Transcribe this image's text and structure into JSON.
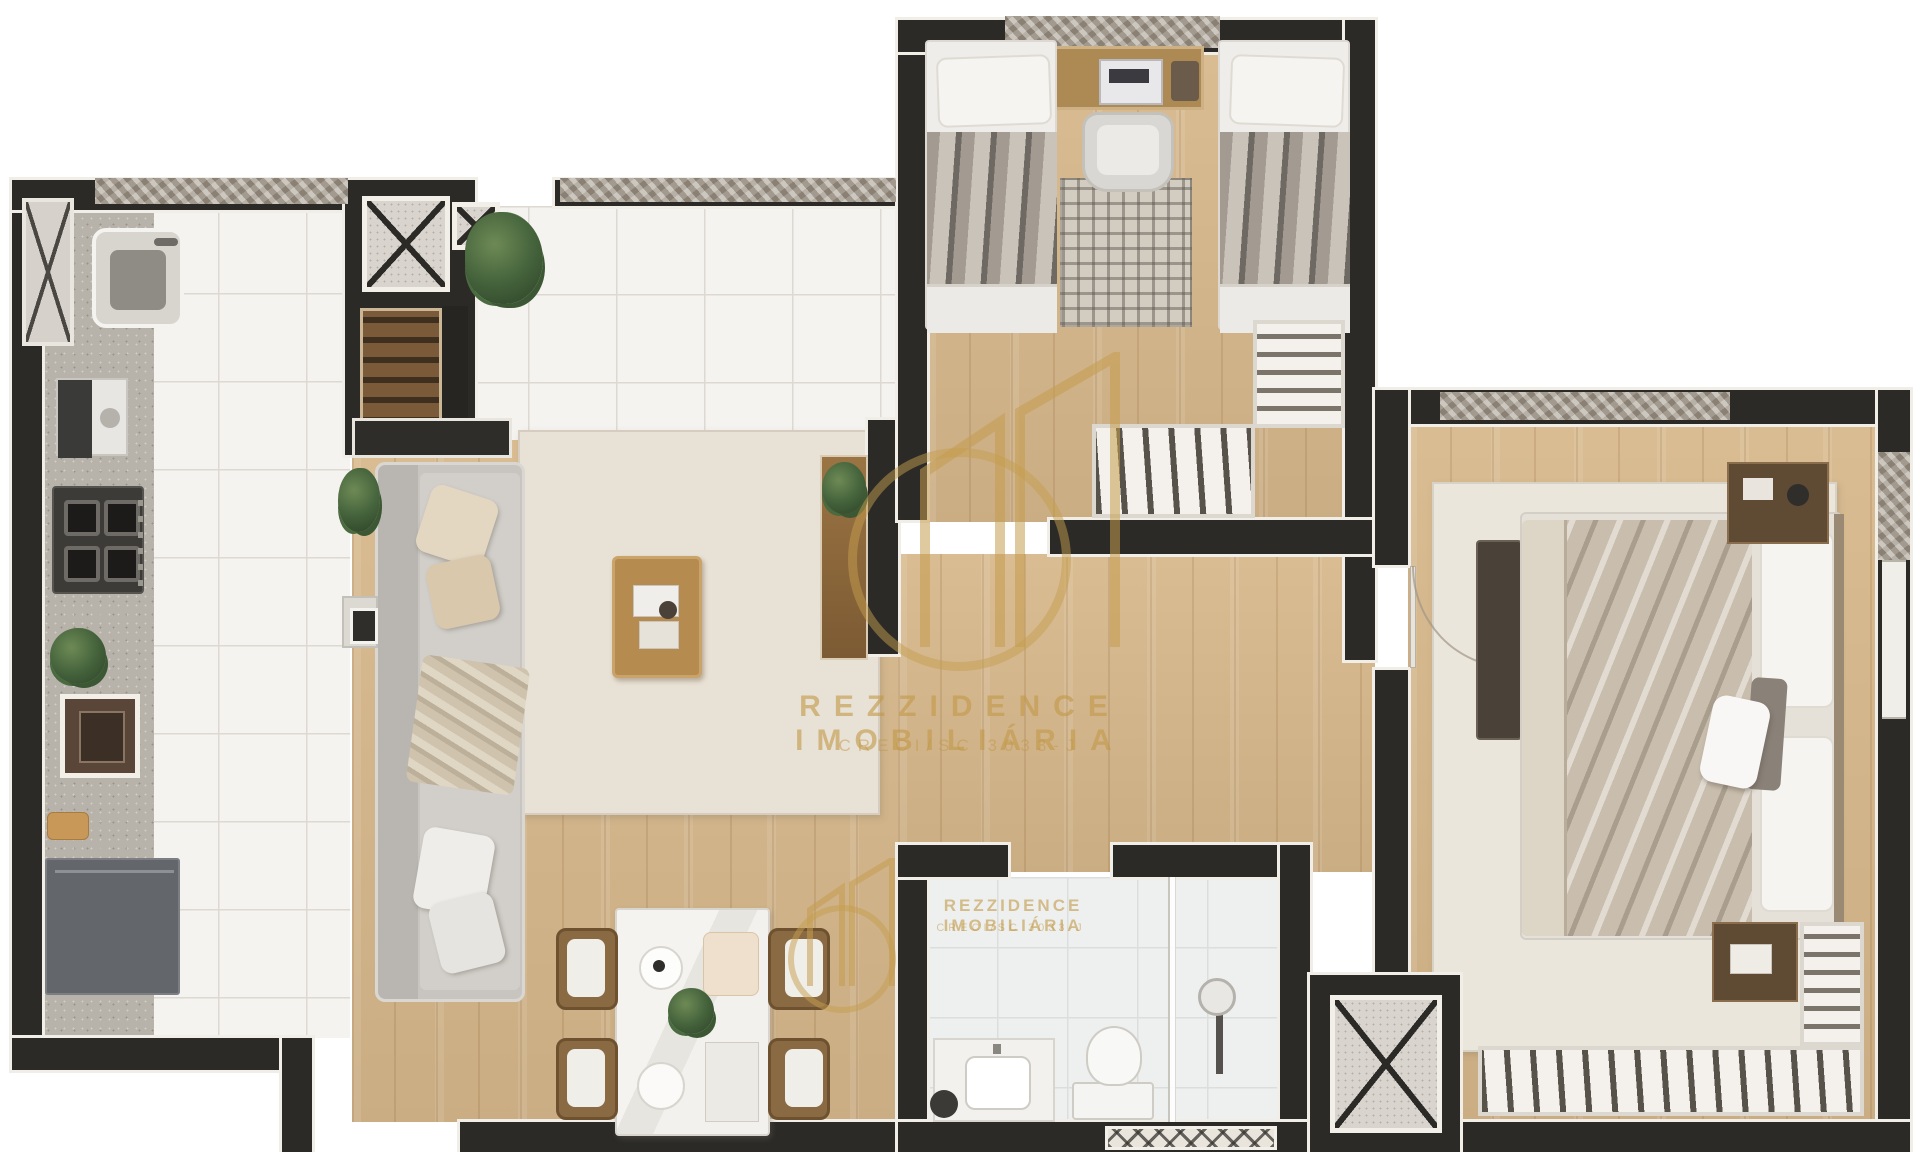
{
  "watermark": {
    "brand": "REZZIDENCE IMOBILIÁRIA",
    "registration": "CRECI/SC 3033-J",
    "color": "#C59D4E"
  },
  "watermark_secondary": {
    "brand": "REZZIDENCE IMOBILIÁRIA",
    "registration": "CRECI/SC 3033-J"
  },
  "palette": {
    "background": "#FFFFFF",
    "wall": "#2B2A27",
    "wall_trim": "#F1EEE8",
    "wood_floor": "#D7B88B",
    "tile_floor": "#F5F3EF",
    "counter": "#B7B2AA",
    "concrete_sill": "#A69D8F",
    "rug": "#E8E1D5",
    "sofa": "#C8C5C0",
    "cabinet_dark": "#63666A",
    "wood_furniture": "#AD8954",
    "gold": "#C59D4E"
  },
  "legend": {
    "view": "top-down apartment floor plan render",
    "rooms": [
      "kitchen",
      "living-room",
      "dining-area",
      "terrace",
      "twin-bedroom",
      "master-bedroom",
      "bathroom",
      "hallway",
      "elevator-shaft",
      "utility-shaft"
    ],
    "furniture": [
      "kitchen-sink",
      "coffee-machine",
      "cooktop",
      "oven",
      "refrigerator",
      "sofa",
      "coffee-table",
      "tv-console",
      "sideboard",
      "dining-table",
      "dining-chair",
      "twin-bed",
      "desk",
      "desk-chair",
      "wardrobe",
      "double-bed",
      "nightstand",
      "bench",
      "vanity",
      "toilet",
      "shower",
      "plant"
    ]
  }
}
